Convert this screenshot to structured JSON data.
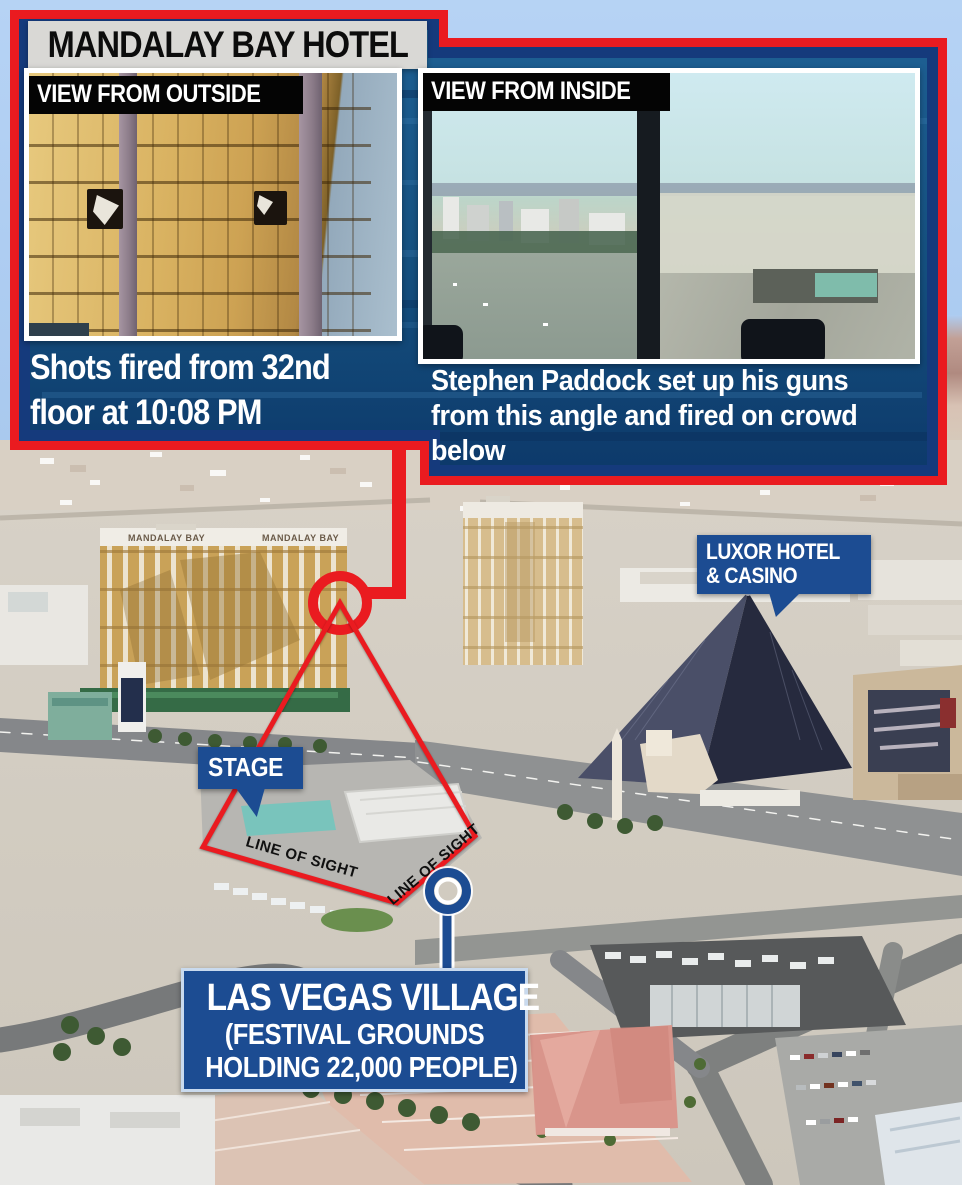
{
  "panel": {
    "title": "MANDALAY BAY HOTEL",
    "outside": {
      "label": "VIEW FROM OUTSIDE",
      "caption_lines": [
        "Shots fired from 32nd",
        "floor at 10:08 PM"
      ]
    },
    "inside": {
      "label": "VIEW FROM INSIDE",
      "caption_lines": [
        "Stephen Paddock set up his guns",
        "from this angle and fired on crowd",
        "below"
      ]
    }
  },
  "map": {
    "mandalay_roof": "MANDALAY BAY",
    "luxor_label_lines": [
      "LUXOR HOTEL",
      "& CASINO"
    ],
    "stage_label": "STAGE",
    "village_label_lines": [
      "LAS VEGAS VILLAGE",
      "(FESTIVAL GROUNDS",
      "HOLDING 22,000 PEOPLE)"
    ],
    "line_of_sight": "LINE OF SIGHT"
  },
  "colors": {
    "accent_red": "#ea1b20",
    "navy_border": "#153a7c",
    "panel_water_blue": "#11497e",
    "label_blue": "#1c4c92",
    "title_bar_gray": "#d9d8d5",
    "bar_black": "#040404",
    "sky_blue": "#aecdf2",
    "mandalay_gold": "#c9a258",
    "luxor_pyramid": "#2a2e42",
    "stage_teal": "#79c4bc",
    "ground_beige": "#d5cfc5"
  }
}
